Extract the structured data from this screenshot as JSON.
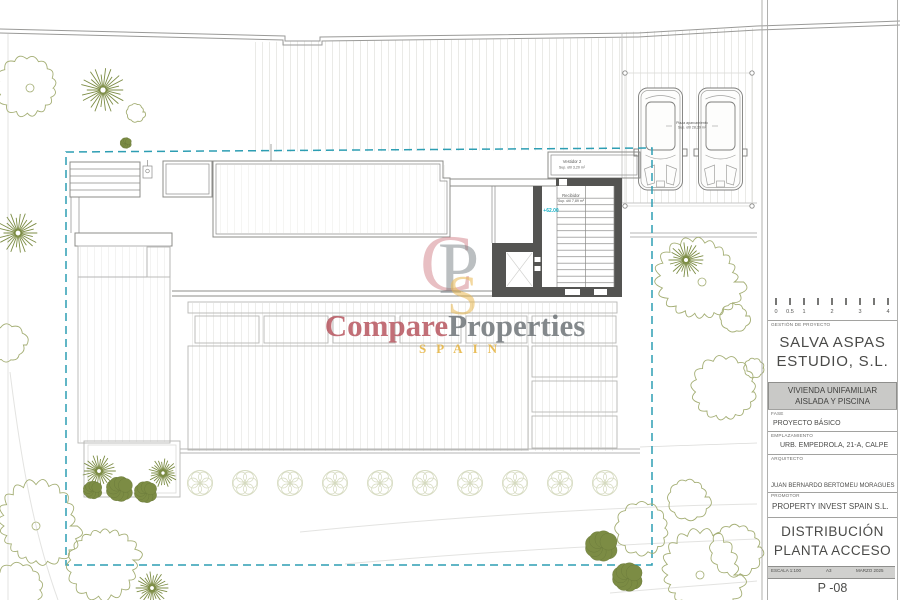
{
  "colors": {
    "boundary": "#2d9eb3",
    "wall": "#8c8c8a",
    "wall_dark": "#545452",
    "terrace_line": "#b6b6b4",
    "tree_outline": "#a4ae74",
    "tree_fill": "#7c8c44",
    "level_text": "#18b1c6",
    "watermark_red": "#b5505a",
    "watermark_gray": "#6a7074",
    "watermark_gold": "#e6b33e",
    "band_fill": "#c9c9c7"
  },
  "watermark": {
    "word1": "Compare",
    "word2": "Properties",
    "subtitle": "SPAIN",
    "monogram": {
      "c": "C",
      "p": "P",
      "s": "S"
    }
  },
  "plan_labels": {
    "room_top": {
      "name": "Vestidor 2",
      "area": "Sup. útil 3,20 m²"
    },
    "room_hall": {
      "name": "Recibidor",
      "area": "Sup. útil 7,89 m²"
    },
    "level": "+62.00",
    "parking": {
      "name": "Plaza aparcamiento",
      "area": "Sup. útil 28,29 m²"
    }
  },
  "scalebar": {
    "labels": [
      "0",
      "0.5",
      "1",
      "",
      "2",
      "",
      "3",
      "",
      "4"
    ]
  },
  "titleblock": {
    "section_label": "GESTIÓN DE PROYECTO",
    "company": {
      "line1": "SALVA ASPAS",
      "line2": "ESTUDIO, S.L."
    },
    "project": {
      "line1": "VIVIENDA UNIFAMILIAR",
      "line2": "AISLADA Y PISCINA"
    },
    "fase": {
      "label": "FASE",
      "value": "PROYECTO BÁSICO"
    },
    "emplazamiento": {
      "label": "EMPLAZAMIENTO",
      "value": "URB. EMPEDROLA, 21-A, CALPE"
    },
    "arquitecto": {
      "label": "ARQUITECTO",
      "value": "JUAN BERNARDO BERTOMEU MORAGUES"
    },
    "promotor": {
      "label": "PROMOTOR",
      "value": "PROPERTY INVEST SPAIN S.L."
    },
    "drawing": {
      "line1": "DISTRIBUCIÓN",
      "line2": "PLANTA ACCESO"
    },
    "footer": {
      "escala": "ESCALA 1:100",
      "formato": "A3",
      "fecha": "MARZO 2025"
    },
    "sheet_number": "P -08"
  }
}
